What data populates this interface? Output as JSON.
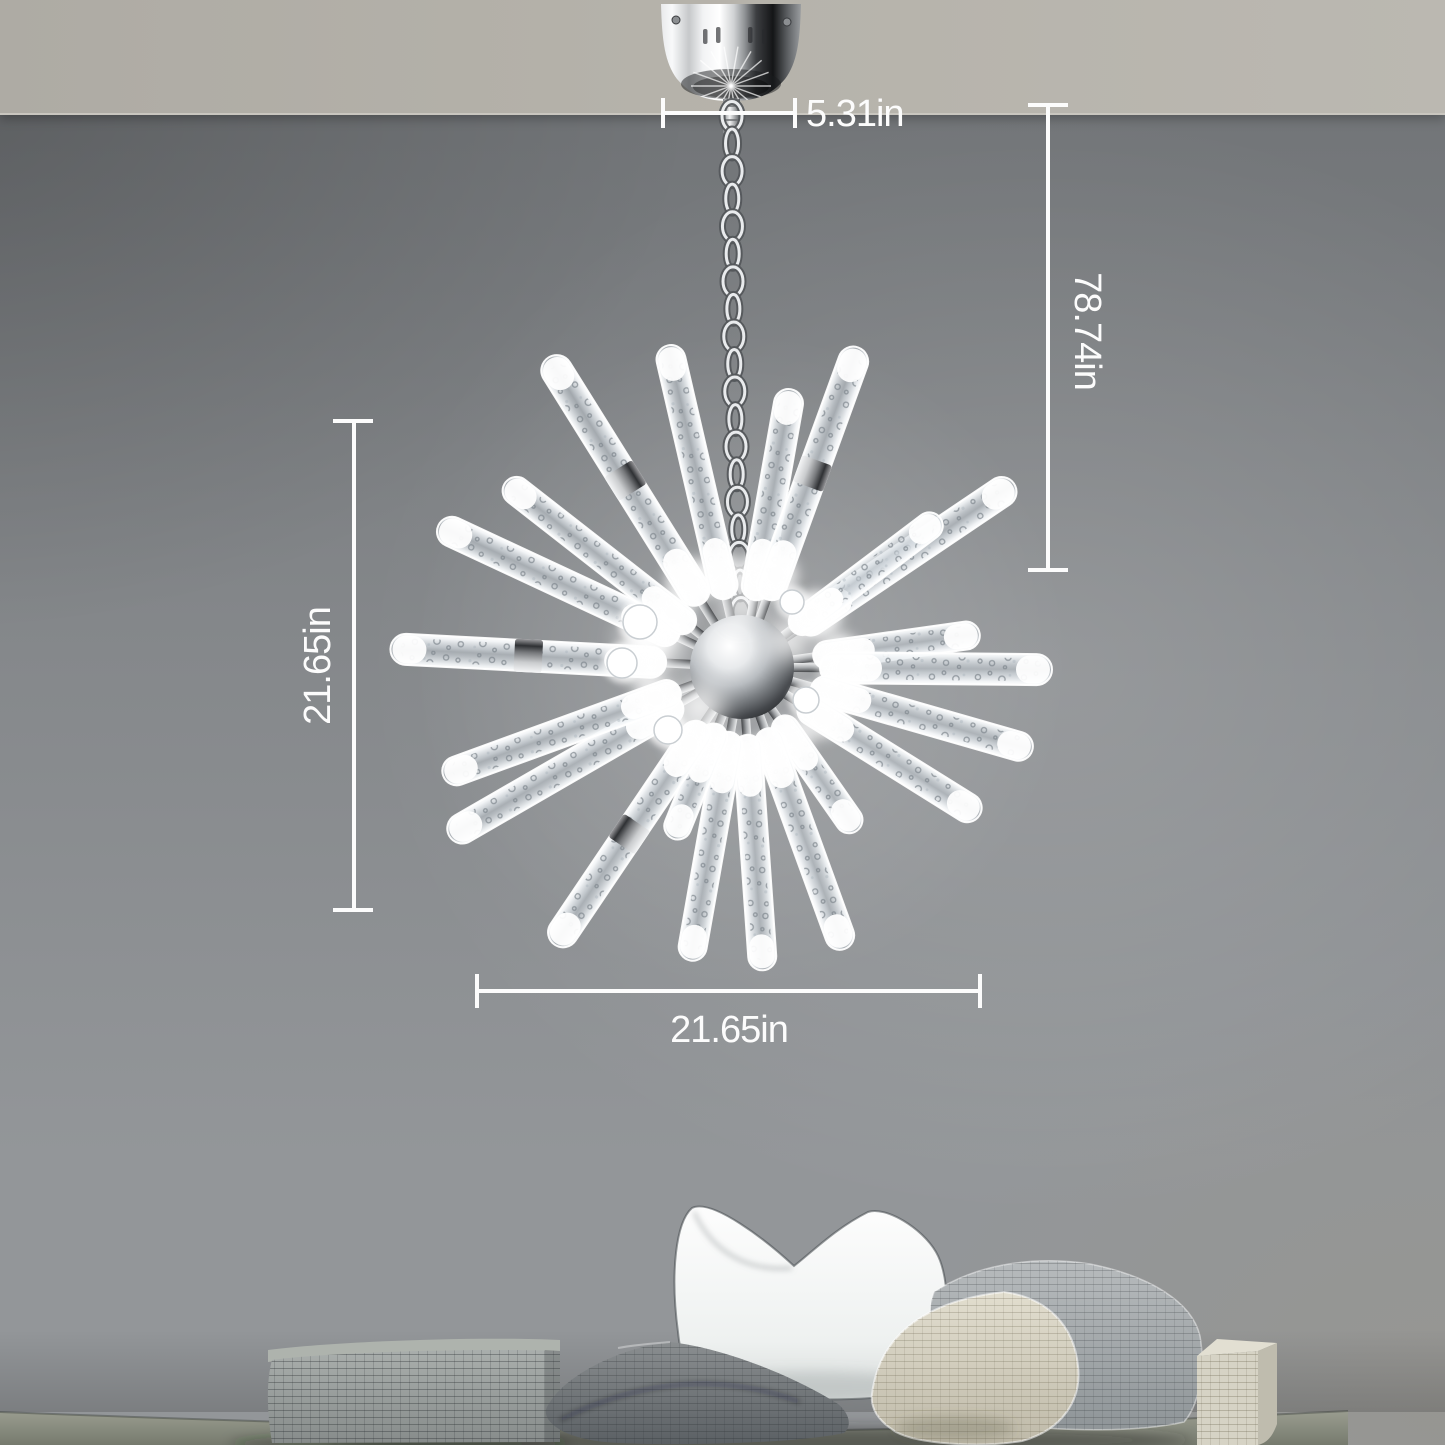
{
  "image": {
    "width": 1445,
    "height": 1445,
    "description": "Chrome LED crystal bubble-rod sputnik chandelier hanging by a chain from a ceiling canopy against a gray wall, with white product dimension annotations; bench with pillows at bottom of wall"
  },
  "dimensions": {
    "canopy_width": "5.31in",
    "overall_height": "78.74in",
    "fixture_height": "21.65in",
    "fixture_width": "21.65in"
  },
  "palette": {
    "ceiling": "#b5b2aa",
    "ceiling_edge": "#c9c6bf",
    "wall_top": "#6e7174",
    "wall_mid": "#85888b",
    "wall_light": "#939699",
    "dimension_line": "#fcfcfc",
    "chrome_light": "#f2f3f4",
    "chrome_dark": "#1a1c1e",
    "seat": "#8d9084",
    "pillow_white": "#f3f5f4",
    "pillow_dark_gray": "#7c8285",
    "pillow_cream": "#d8d4c6",
    "pillow_gray_light": "#b0b4b6",
    "cube": "#d6d3c5"
  },
  "scene_objects": [
    "ceiling",
    "gray-wall",
    "chrome-canopy",
    "hanging-chain",
    "chrome-center-sphere",
    "crystal-bubble-rods",
    "bench-seat",
    "bolster-cushion",
    "white-pillow",
    "dark-gray-pillow",
    "beige-pillow",
    "gray-textured-pillow",
    "textured-cube"
  ],
  "fixture": {
    "center": {
      "x": 742,
      "y": 667
    },
    "sphere_radius": 52,
    "canopy": {
      "cx": 731,
      "top": 4,
      "bottom": 101,
      "half_width": 70
    },
    "chain": {
      "x1": 732,
      "x2": 741,
      "y1": 116,
      "y2": 612,
      "count": 19
    },
    "rods": [
      [
        -122,
        75,
        365,
        31,
        1
      ],
      [
        -103,
        70,
        330,
        29,
        0
      ],
      [
        -80,
        68,
        282,
        29,
        0
      ],
      [
        -70,
        72,
        340,
        30,
        1
      ],
      [
        -34,
        68,
        328,
        30,
        0
      ],
      [
        -37,
        62,
        248,
        27,
        0
      ],
      [
        -8,
        72,
        240,
        28,
        0
      ],
      [
        0.5,
        78,
        310,
        31,
        0
      ],
      [
        16,
        72,
        302,
        29,
        0
      ],
      [
        32,
        68,
        280,
        29,
        0
      ],
      [
        55,
        62,
        200,
        27,
        0
      ],
      [
        70,
        66,
        300,
        29,
        0
      ],
      [
        86,
        68,
        304,
        28,
        0
      ],
      [
        100,
        66,
        298,
        28,
        0
      ],
      [
        112,
        62,
        185,
        27,
        0
      ],
      [
        124,
        68,
        335,
        30,
        1
      ],
      [
        150,
        70,
        338,
        30,
        0
      ],
      [
        160,
        66,
        318,
        29,
        0
      ],
      [
        183,
        76,
        352,
        31,
        1
      ],
      [
        -155,
        70,
        335,
        30,
        0
      ],
      [
        -142,
        62,
        300,
        28,
        0
      ]
    ],
    "stubs": [
      [
        640,
        622,
        17
      ],
      [
        622,
        663,
        15
      ],
      [
        668,
        730,
        14
      ],
      [
        806,
        700,
        13
      ],
      [
        792,
        602,
        12
      ]
    ],
    "glows": [
      [
        652,
        641,
        30
      ],
      [
        700,
        707,
        24
      ],
      [
        788,
        640,
        20
      ],
      [
        742,
        606,
        18
      ]
    ]
  }
}
